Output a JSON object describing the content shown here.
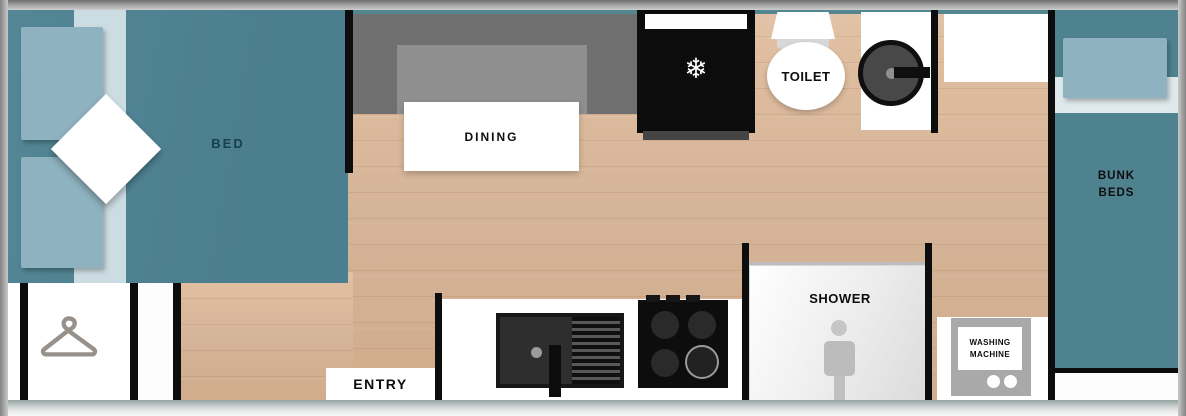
{
  "plan_type": "caravan-floorplan",
  "rooms": {
    "bed": {
      "label": "BED"
    },
    "dining": {
      "label": "DINING"
    },
    "fridge": {
      "icon": "snowflake-icon",
      "snowflake_glyph": "❄"
    },
    "toilet": {
      "label": "TOILET"
    },
    "shower": {
      "label": "SHOWER"
    },
    "washing_machine": {
      "line1": "WASHING",
      "line2": "MACHINE"
    },
    "bunk_beds": {
      "line1": "BUNK",
      "line2": "BEDS"
    },
    "entry": {
      "label": "ENTRY"
    },
    "wardrobe": {
      "icon": "hanger-icon"
    }
  },
  "colors": {
    "accent_teal": "#4E8291",
    "pillow_blue": "#8FB2C0",
    "sheet_blue": "#CBDCE2",
    "floor_wood": "#DEBC9E",
    "wall_black": "#0D0D0D",
    "bench_gray": "#6F6F6F",
    "backrest_gray": "#8F8F8F",
    "shower_icon_gray": "#BDBDBD",
    "washer_gray": "#A9A9A9",
    "bed_label_teal": "#17404B"
  }
}
